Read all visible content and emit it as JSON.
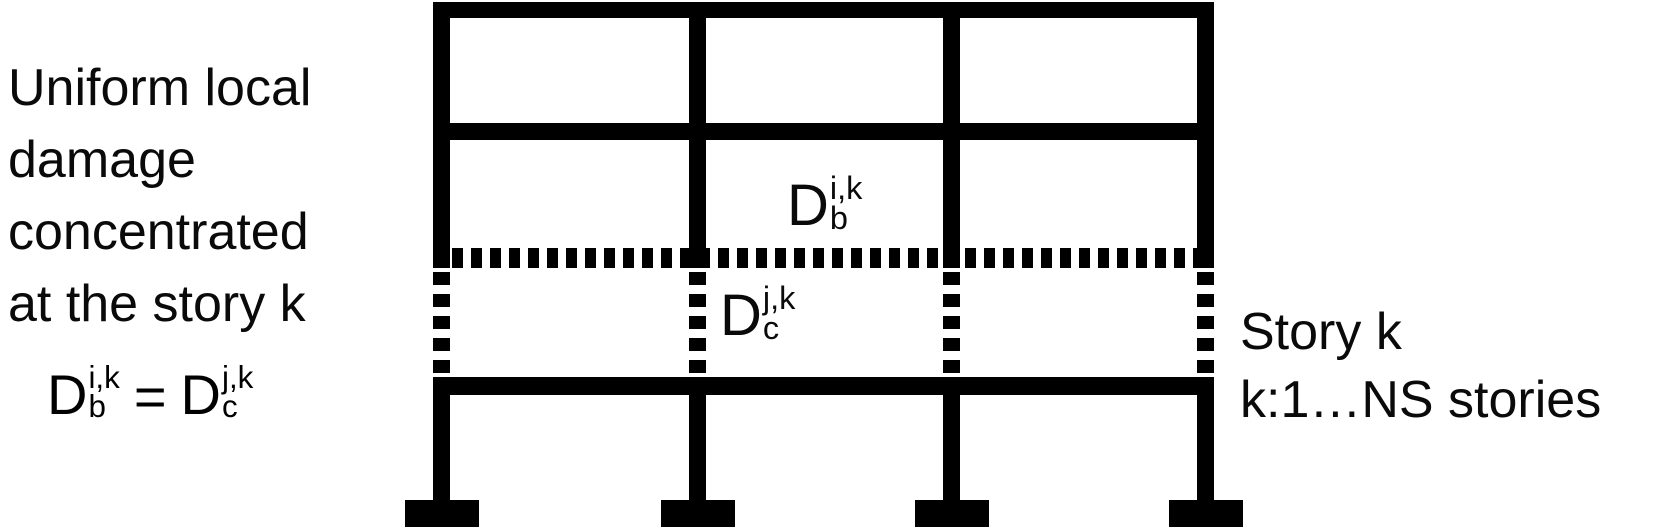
{
  "left_note": {
    "lines": [
      "Uniform local",
      "damage",
      "concentrated",
      "at the story k"
    ]
  },
  "equation": {
    "lhs": {
      "base": "D",
      "sup": "i,k",
      "sub": "b"
    },
    "equals": "=",
    "rhs": {
      "base": "D",
      "sup": "j,k",
      "sub": "c"
    }
  },
  "frame_labels": {
    "beam_damage": {
      "base": "D",
      "sup": "i,k",
      "sub": "b"
    },
    "column_damage": {
      "base": "D",
      "sup": "j,k",
      "sub": "c"
    }
  },
  "right_note": {
    "line1": "Story k",
    "line2": "k:1…NS stories"
  },
  "diagram": {
    "type": "frame-elevation",
    "bays": 3,
    "columns": 4,
    "damaged_story": "k",
    "damage_style": "dotted beam line and dashed column segments at story k"
  },
  "colors": {
    "ink": "#000000",
    "background": "#ffffff"
  }
}
